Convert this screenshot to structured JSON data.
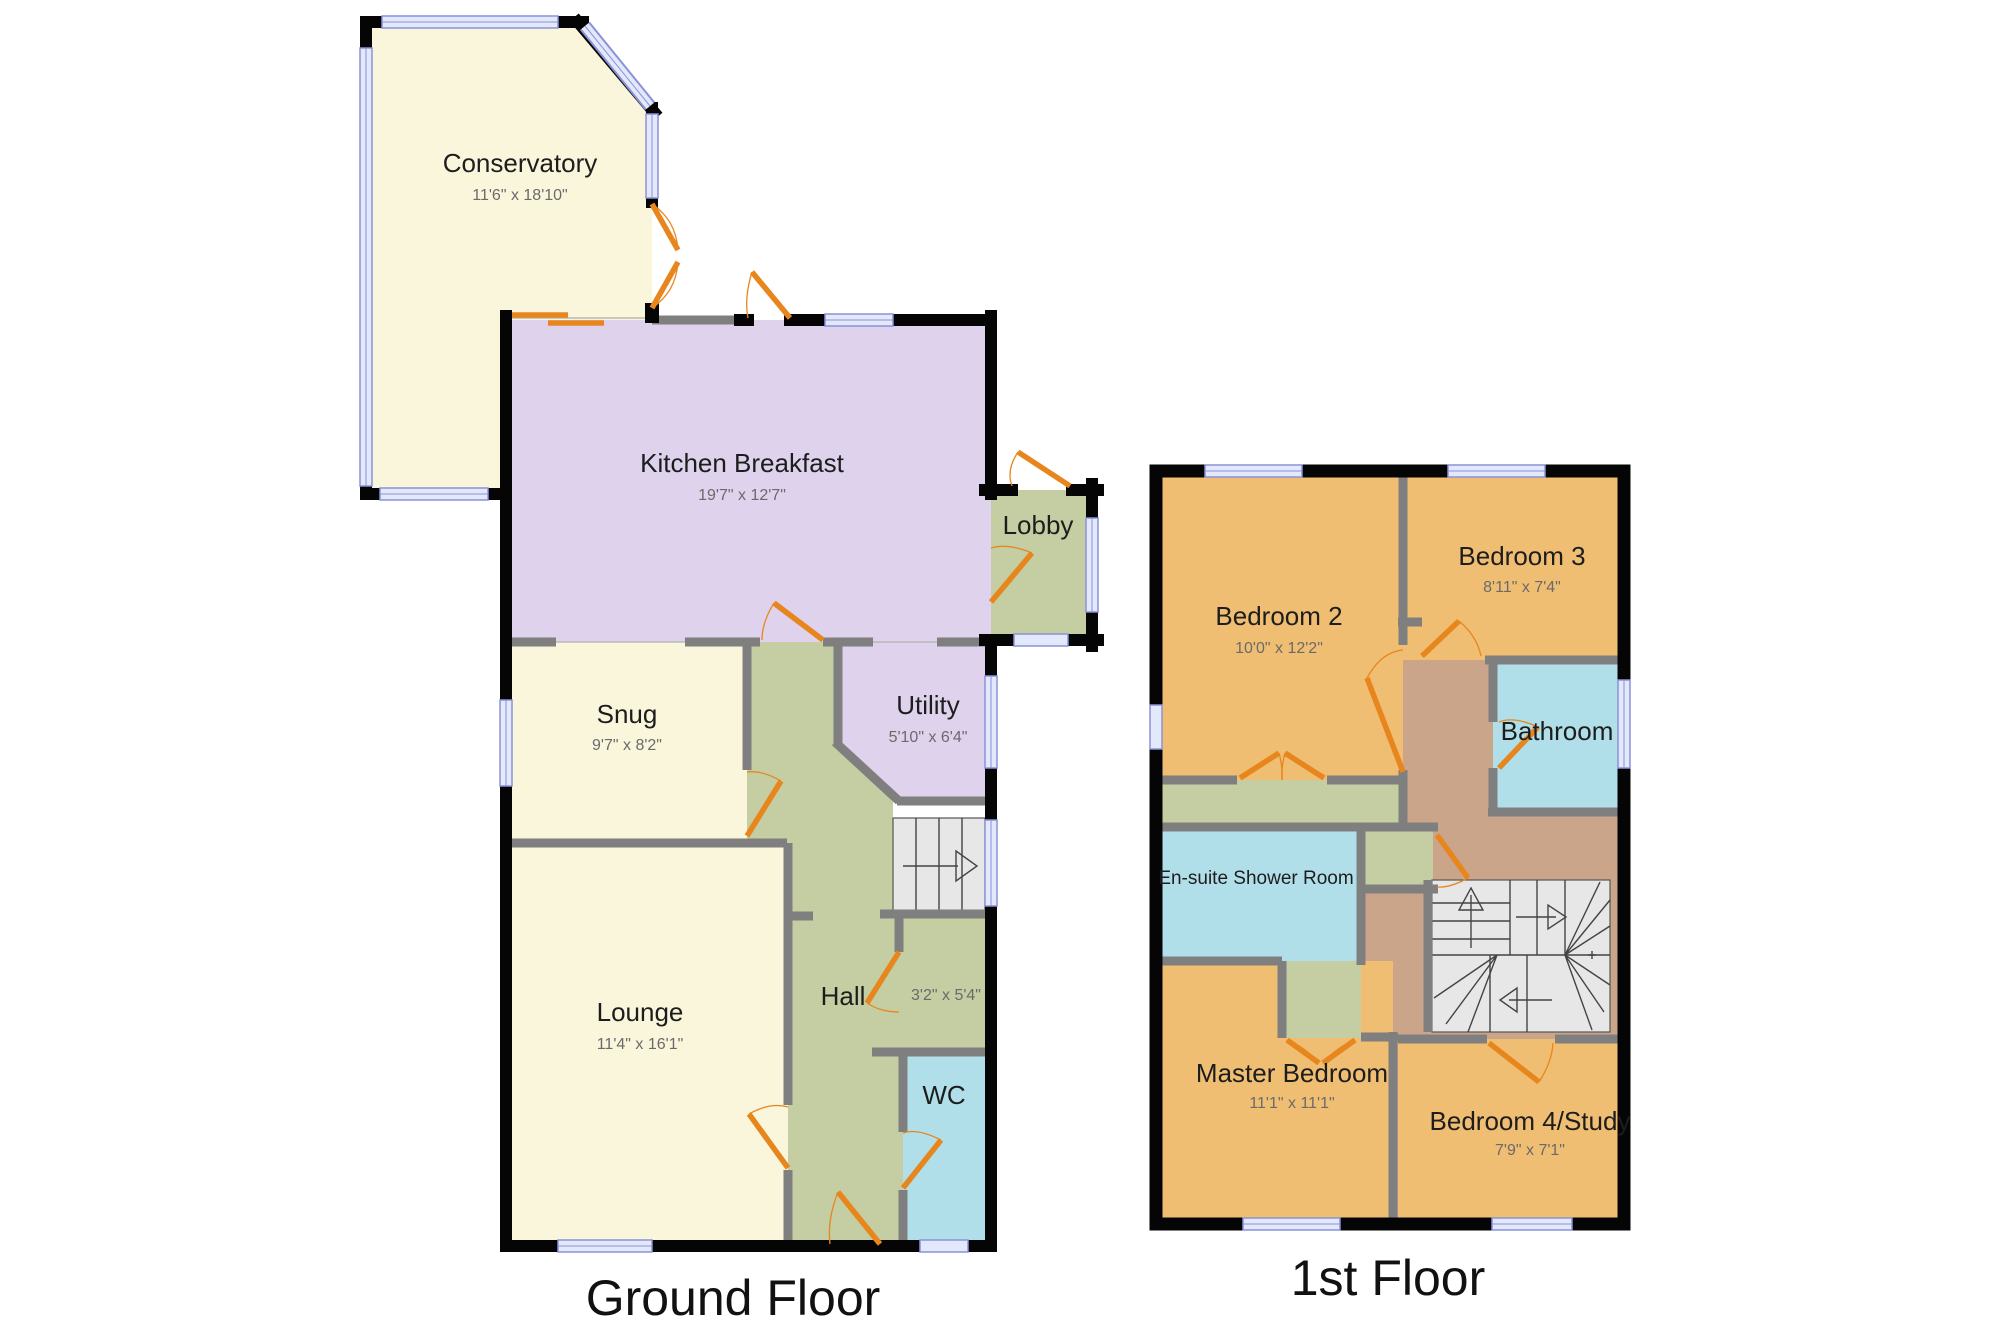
{
  "floors": [
    {
      "title": "Ground Floor",
      "rooms": [
        {
          "id": "conservatory",
          "name": "Conservatory",
          "dims": "11'6\" x 18'10\""
        },
        {
          "id": "kitchen-breakfast",
          "name": "Kitchen Breakfast",
          "dims": "19'7\" x 12'7\""
        },
        {
          "id": "lobby",
          "name": "Lobby",
          "dims": ""
        },
        {
          "id": "snug",
          "name": "Snug",
          "dims": "9'7\" x 8'2\""
        },
        {
          "id": "utility",
          "name": "Utility",
          "dims": "5'10\" x 6'4\""
        },
        {
          "id": "hall",
          "name": "Hall",
          "dims": "3'2\" x 5'4\""
        },
        {
          "id": "lounge",
          "name": "Lounge",
          "dims": "11'4\" x 16'1\""
        },
        {
          "id": "wc",
          "name": "WC",
          "dims": ""
        }
      ]
    },
    {
      "title": "1st Floor",
      "rooms": [
        {
          "id": "bedroom-2",
          "name": "Bedroom 2",
          "dims": "10'0\" x 12'2\""
        },
        {
          "id": "bedroom-3",
          "name": "Bedroom 3",
          "dims": "8'11\" x 7'4\""
        },
        {
          "id": "bathroom",
          "name": "Bathroom",
          "dims": ""
        },
        {
          "id": "ensuite",
          "name": "En-suite Shower Room",
          "dims": ""
        },
        {
          "id": "master-bedroom",
          "name": "Master Bedroom",
          "dims": "11'1\" x 11'1\""
        },
        {
          "id": "bedroom-4-study",
          "name": "Bedroom 4/Study",
          "dims": "7'9\" x 7'1\""
        }
      ]
    }
  ],
  "palette": {
    "room_cream": "#faf6dc",
    "room_purple": "#ded2ec",
    "room_green": "#c4cea2",
    "room_blue": "#b0dfea",
    "room_orange": "#efbe72",
    "landing_tan": "#cba58a",
    "stairs_fill": "#e7e7e7",
    "wall_exterior": "#050505",
    "wall_interior": "#7f7f7f",
    "window_fill": "#e4e8fb",
    "window_frame": "#8a92d8",
    "door_orange": "#e8861e"
  }
}
